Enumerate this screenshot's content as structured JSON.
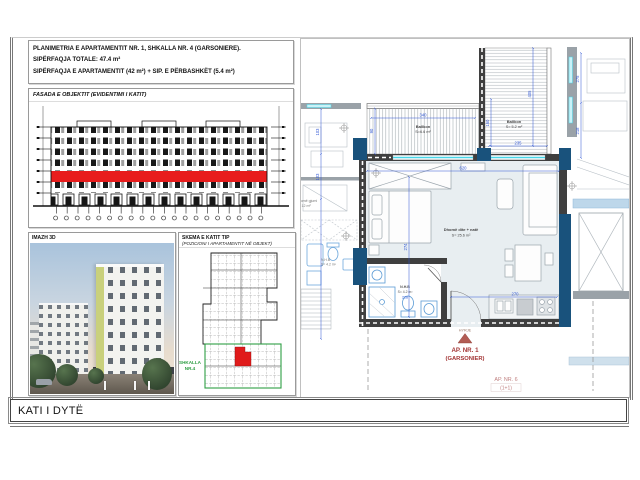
{
  "header": {
    "line1": "PLANIMETRIA E APARTAMENTIT NR. 1, SHKALLA NR. 4 (GARSONIERE).",
    "line2": "SIPËRFAQJA TOTALE: 47.4 m²",
    "line3": "SIPËRFAQJA E APARTAMENTIT (42 m²) + SIP. E PËRBASHKËT (5.4 m²)"
  },
  "facade": {
    "title": "FASADA E OBJEKTIT (EVIDENTIMI I KATIT)"
  },
  "image3d": {
    "title": "IMAZH 3D"
  },
  "keyplan": {
    "title": "SKEMA E KATIT TIP",
    "subtitle": "(POZICIONI I APARTAMENTIT NË OBJEKT)",
    "stair1": "SHKALLA",
    "stair2": "NR.4"
  },
  "plan": {
    "balcony_top_name": "Ballkon",
    "balcony_top_area": "S=6.6 m²",
    "balcony_right_name": "Ballkon",
    "balcony_right_area": "S= 5.2 m²",
    "living_name": "Dhomë dite + natë",
    "living_area": "S= 25.6 m²",
    "bath_name": "N.H.B",
    "bath_area": "S= 4.2 m²",
    "neighbor_bath_name": "N.H.B",
    "neighbor_bath_area": "S= 4.2 m²",
    "neighbor_bed_name": "Dhomë gjumi",
    "neighbor_bed_area": "S= 12 m²",
    "entry": "HYRJE",
    "ap1": "AP. NR. 1",
    "ap1_type": "(GARSONIER)",
    "ap6": "AP. NR. 6",
    "ap6_type": "(1+1)",
    "dims": {
      "d340": "340",
      "d90": "90",
      "d235": "235",
      "d160": "160",
      "d405": "405",
      "d620": "620",
      "d274": "274",
      "d270": "270",
      "d228": "228",
      "d103a": "103",
      "d103b": "103",
      "d275": "275",
      "d218": "218"
    }
  },
  "titlebar": {
    "text": "KATI I DYTË"
  },
  "colors": {
    "dim_blue": "#2e55d4",
    "column_blue": "#19527c",
    "wall_dark": "#3f3f3f",
    "highlight_red": "#e81c1c",
    "apartment_red": "#a33535",
    "neighbor_red": "#c08080",
    "green": "#2e9e44",
    "window_cyan": "#49d6e8",
    "room_fill": "#e8eef1"
  }
}
